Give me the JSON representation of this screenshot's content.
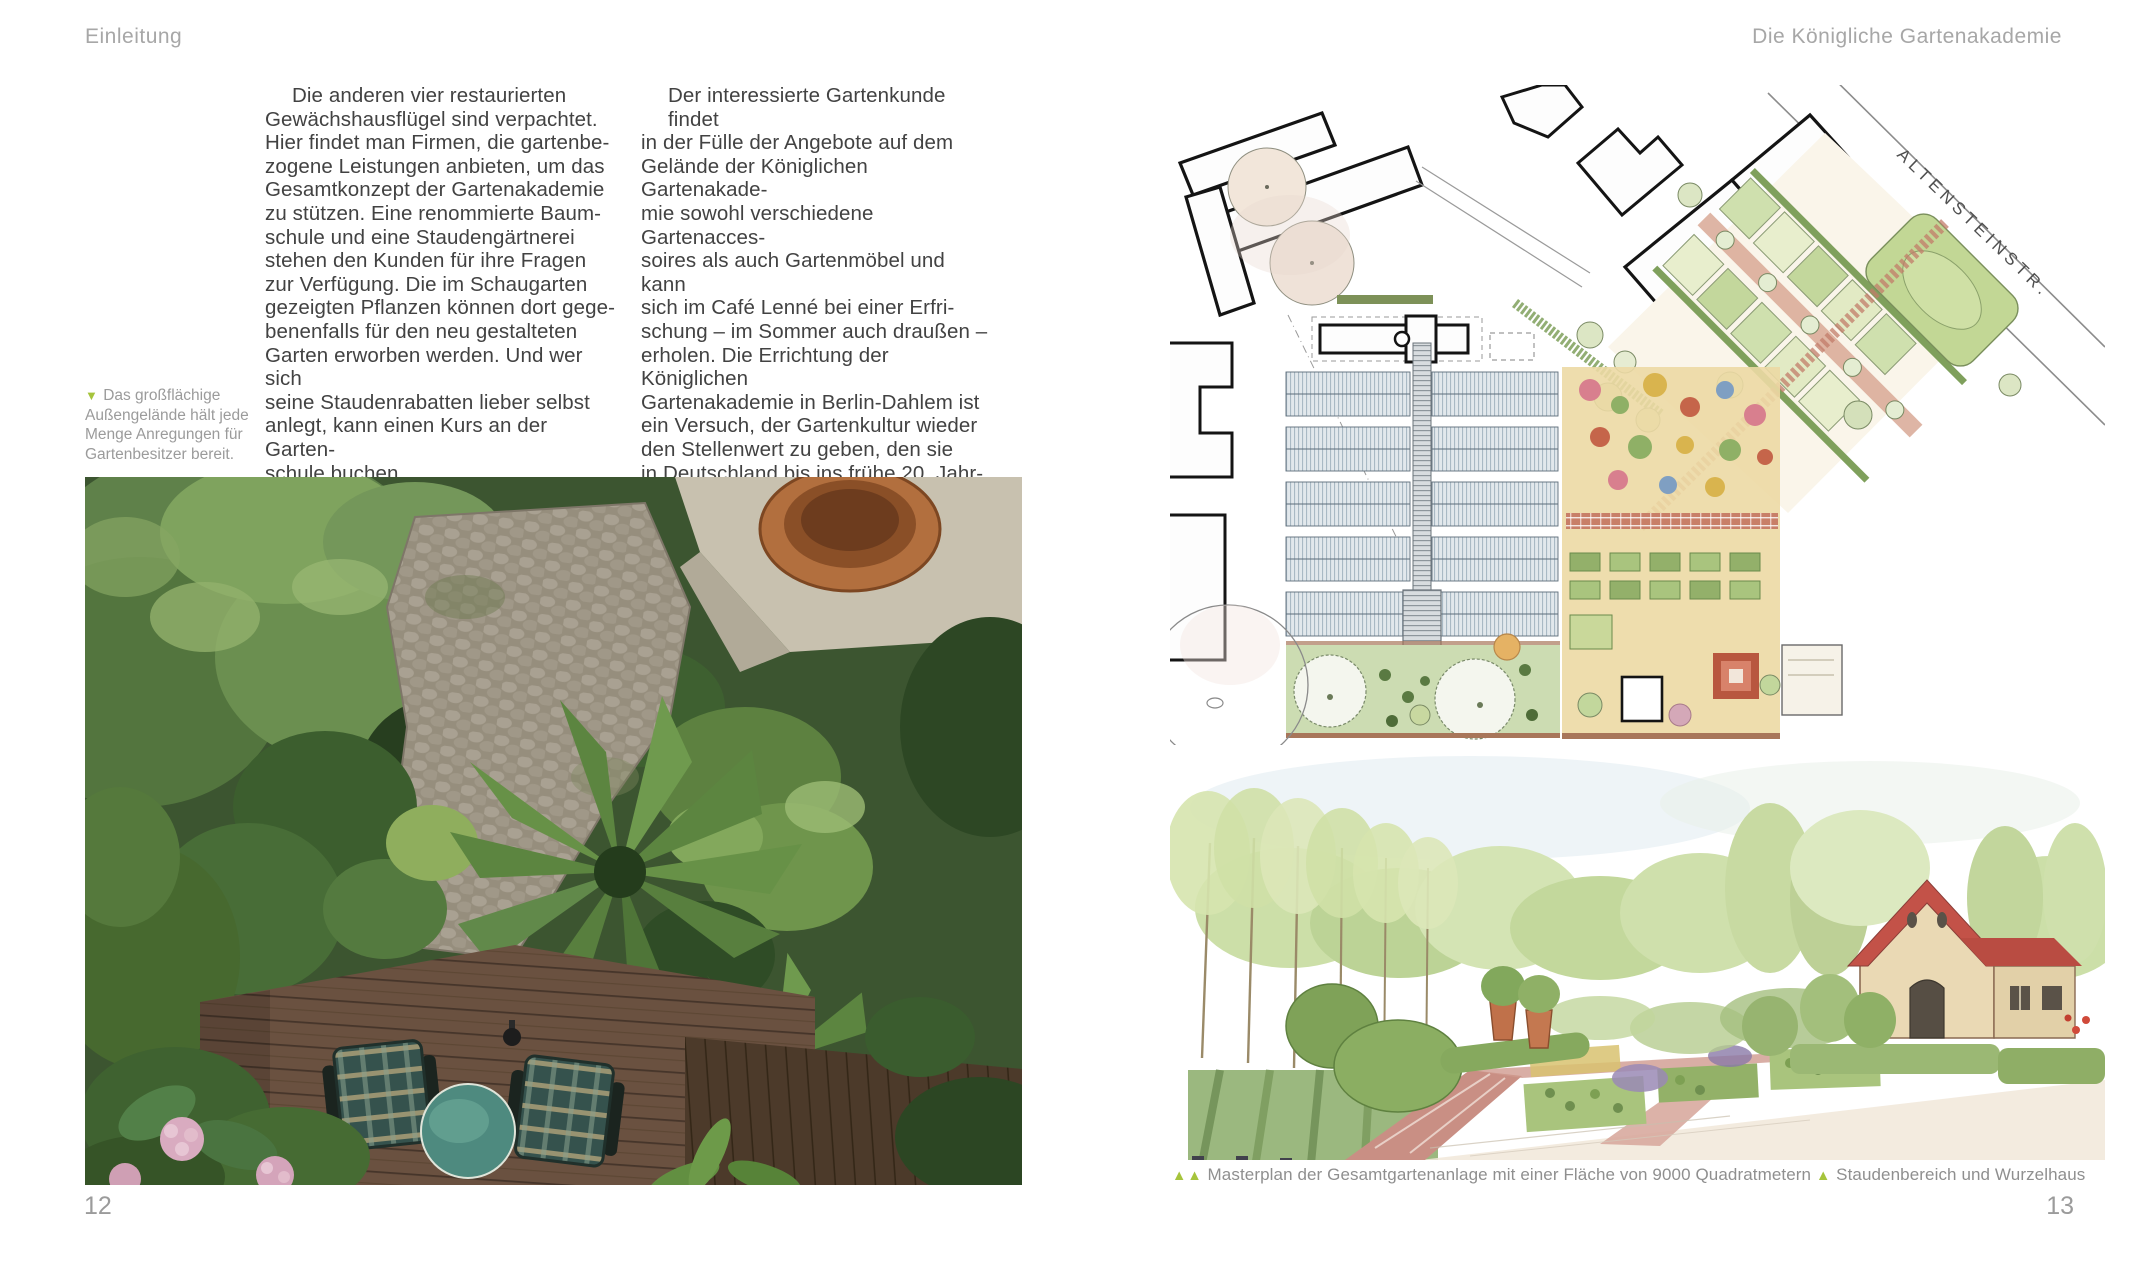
{
  "colors": {
    "accent_green": "#a6c43c",
    "header_gray": "#a7a7a7",
    "body_text": "#424242",
    "caption_gray": "#9b9b9b"
  },
  "left_page": {
    "header": "Einleitung",
    "page_number": "12",
    "column1_lines": [
      "Die anderen vier restaurierten",
      "Gewächshausflügel sind verpachtet.",
      "Hier findet man Firmen, die gartenbe-",
      "zogene Leistungen anbieten, um das",
      "Gesamtkonzept der Gartenakademie",
      "zu stützen. Eine renommierte Baum-",
      "schule und eine Staudengärtnerei",
      "stehen den Kunden für ihre Fragen",
      "zur Verfügung. Die im Schaugarten",
      "gezeigten Pflanzen können dort gege-",
      "benenfalls für den neu gestalteten",
      "Garten erworben werden. Und wer sich",
      "seine Staudenrabatten lieber selbst",
      "anlegt, kann einen Kurs an der Garten-",
      "schule buchen."
    ],
    "column2_lines": [
      "Der interessierte Gartenkunde findet",
      "in der Fülle der Angebote auf dem",
      "Gelände der Königlichen Gartenakade-",
      "mie sowohl verschiedene Gartenacces-",
      "soires als auch Gartenmöbel und kann",
      "sich im Café Lenné bei einer Erfri-",
      "schung – im Sommer auch draußen –",
      "erholen. Die Errichtung der Königlichen",
      "Gartenakademie in Berlin-Dahlem ist",
      "ein Versuch, der Gartenkultur wieder",
      "den Stellenwert zu geben, den sie",
      "in Deutschland bis ins frühe 20. Jahr-",
      "hundert einmal hatte – und damit eine",
      "große Kulturtradition und altes, wert-",
      "volles Wissen wiederzubeleben."
    ],
    "margin_caption": {
      "marker": "▼",
      "text": "Das großflächige Außengelände hält jede Menge Anregungen für Gartenbesitzer bereit."
    }
  },
  "right_page": {
    "header": "Die Königliche Gartenakademie",
    "page_number": "13",
    "plan_street_label": "ALTENSTEINSTR.",
    "caption": {
      "marker_double": "▲▲",
      "text_masterplan": "Masterplan der Gesamtgartenanlage mit einer Fläche von 9000 Quadratmetern",
      "marker_single": "▲",
      "text_sketch": "Staudenbereich und Wurzelhaus"
    }
  }
}
